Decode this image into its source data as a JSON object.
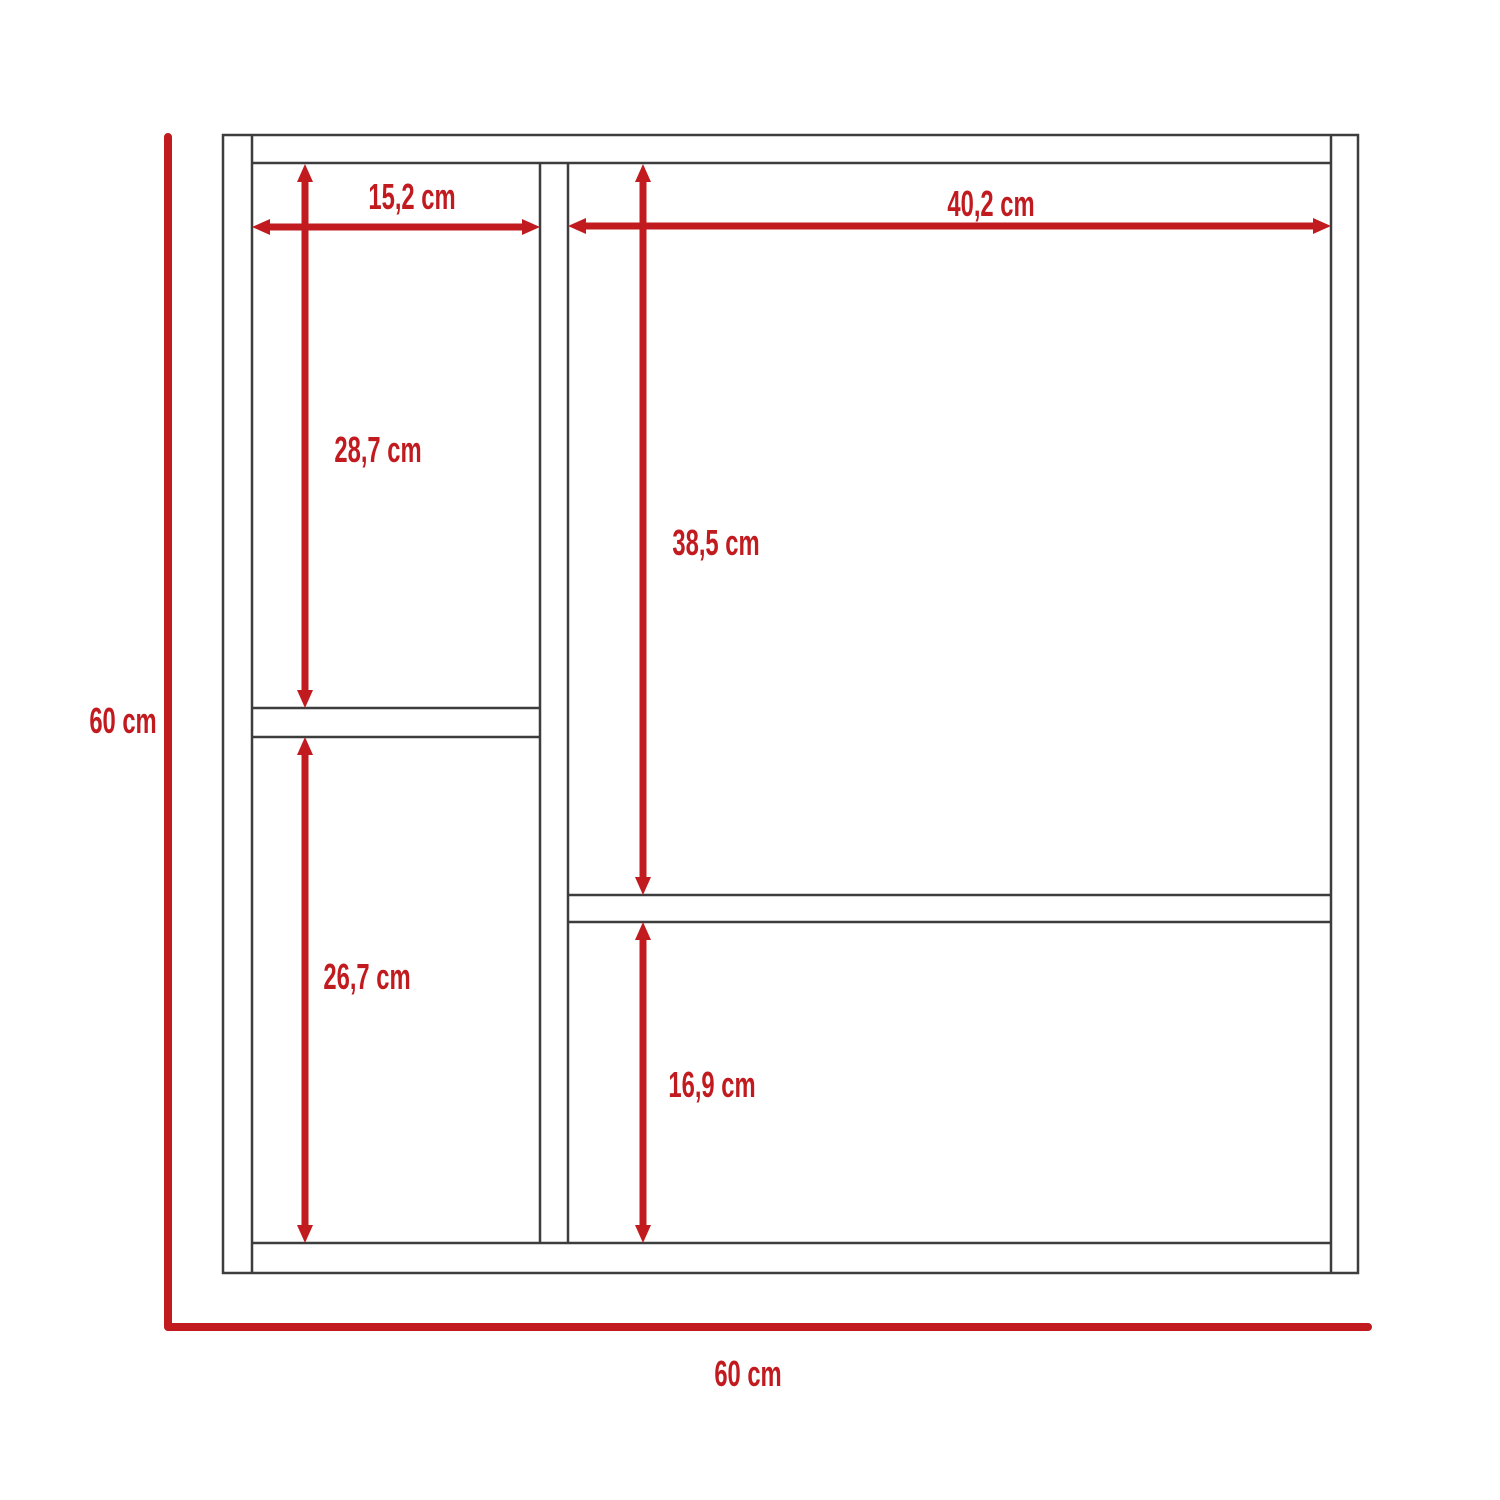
{
  "diagram": {
    "type": "furniture-dimension-drawing",
    "unit": "cm",
    "overall": {
      "height_label": "60 cm",
      "width_label": "60 cm",
      "height_cm": 60,
      "width_cm": 60
    },
    "dimensions": [
      {
        "id": "top-left-width",
        "label": "15,2 cm",
        "value_cm": 15.2,
        "orientation": "horizontal"
      },
      {
        "id": "top-right-width",
        "label": "40,2 cm",
        "value_cm": 40.2,
        "orientation": "horizontal"
      },
      {
        "id": "left-upper-height",
        "label": "28,7 cm",
        "value_cm": 28.7,
        "orientation": "vertical"
      },
      {
        "id": "right-upper-height",
        "label": "38,5 cm",
        "value_cm": 38.5,
        "orientation": "vertical"
      },
      {
        "id": "left-lower-height",
        "label": "26,7 cm",
        "value_cm": 26.7,
        "orientation": "vertical"
      },
      {
        "id": "right-lower-height",
        "label": "16,9 cm",
        "value_cm": 16.9,
        "orientation": "vertical"
      }
    ],
    "colors": {
      "dimension_red": "#c11b20",
      "outline_gray": "#3d3d3d",
      "background": "#ffffff"
    }
  }
}
